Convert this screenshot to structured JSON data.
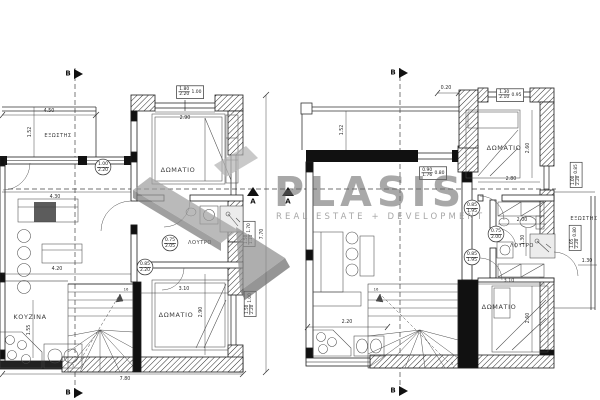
{
  "watermark": {
    "brand": "PLASIS",
    "tagline": "REAL ESTATE + DEVELOPMENT"
  },
  "markers": {
    "section_b": "B",
    "section_a": "A"
  },
  "stairs": {
    "first": "1",
    "last": "16"
  },
  "left": {
    "labels": {
      "balcony": "ΕΞΩΣΤΗΣ",
      "bedroom_top": "ΔΩΜΑΤΙΟ",
      "bathroom": "ΛΟΥΤΡΟ",
      "bedroom_bottom": "ΔΩΜΑΤΙΟ",
      "kitchen": "ΚΟΥΖΙΝΑ"
    },
    "dims": {
      "balcony_width": "4.50",
      "balcony_depth": "1.52",
      "window_top": "2.90",
      "living_width_a": "4.30",
      "living_width_b": "4.20",
      "kitchen_depth": "1.55",
      "bedroom_width": "3.10",
      "bedroom_depth": "2.90",
      "total_width": "7.80",
      "total_depth": "7.70"
    },
    "openings": {
      "window_top": {
        "w": "1.80",
        "h": "2.20",
        "sill": "1.00"
      },
      "balcony_door": {
        "w": "1.00",
        "h": "2.20"
      },
      "bath_door": {
        "w": "0.75",
        "h": "2.05"
      },
      "bedroom_door": {
        "w": "0.85",
        "h": "2.20"
      },
      "window_right_top": {
        "w": "1.50",
        "h": "1.10",
        "sill": "1.70"
      },
      "window_right_bottom": {
        "w": "1.50",
        "h": "2.20",
        "sill": "1.00"
      }
    }
  },
  "right": {
    "labels": {
      "bedroom_top": "ΔΩΜΑΤΙΟ",
      "bathroom": "ΛΟΥΤΡΟ",
      "bedroom_bottom": "ΔΩΜΑΤΙΟ",
      "balcony": "ΕΞΩΣΤΗΣ"
    },
    "dims": {
      "offset_top": "0.20",
      "balcony_depth": "1.52",
      "bedroom_top_width": "2.80",
      "bedroom_top_depth": "2.60",
      "bath_width": "2.00",
      "bath_depth": "1.30",
      "bedroom_width": "3.10",
      "bedroom_depth": "2.60",
      "living_width": "2.20",
      "balcony_width": "1.30"
    },
    "openings": {
      "window_top": {
        "w": "1.30",
        "h": "2.10",
        "sill": "0.95"
      },
      "window_left": {
        "w": "0.90",
        "h": "1.76",
        "sill": "0.80"
      },
      "hall_door": {
        "w": "0.85",
        "h": "1.95"
      },
      "bath_door": {
        "w": "0.75",
        "h": "2.00"
      },
      "bedroom_door": {
        "w": "0.85",
        "h": "1.95"
      },
      "window_right_top": {
        "w": "1.00",
        "h": "2.20",
        "sill": "0.85"
      },
      "window_right_bottom": {
        "w": "1.05",
        "h": "2.20",
        "sill": "0.80"
      }
    }
  }
}
